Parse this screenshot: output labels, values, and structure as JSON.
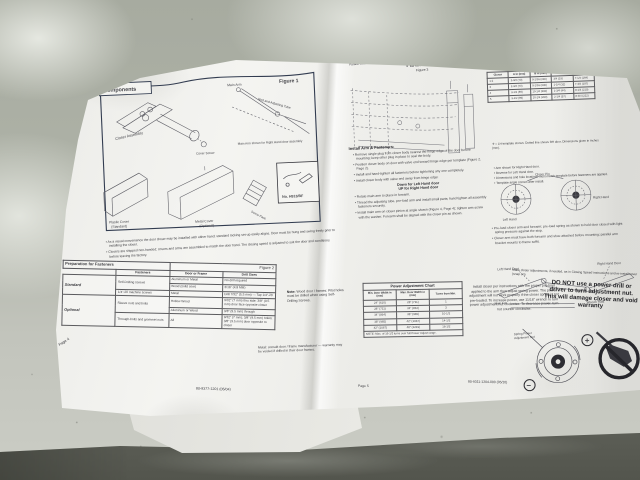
{
  "colors": {
    "surface": "#a7aba0",
    "paper": "#f0f0ed",
    "ink": "#3c3c40",
    "figure_border": "#323c50",
    "bag_dark": "#53554d"
  },
  "left_page": {
    "header_label": "Components",
    "figure_label": "Figure 1",
    "diagram": {
      "closer_assembly": "Closer Assembly",
      "main_arm": "Main Arm",
      "rod_tube": "Rod and Adjusting Tube",
      "arm_note": "Main Arm shown for Right Hand door assembly",
      "cover_screw": "Cover Screw",
      "plastic_cover_1": "Plastic Cover",
      "plastic_cover_2": "(Standard)",
      "metal_cover_1": "Metal Cover",
      "metal_cover_2": "(Optional)",
      "screw_pack": "Screw Pack",
      "parts_box_no": "No. H913/BF"
    },
    "notes": [
      "As a visual convenience the door closer may be installed with either hand; standard locking set-up easily aligns. Door must be hung and swing freely prior to installing the closer.",
      "Closers are shipped non-handed; covers and arms are assembled to match the door hand. The closing speed is adjusted to suit the door and conditions before leaving the factory."
    ],
    "fastener_table": {
      "title": "Preparation for Fasteners",
      "figure": "Figure 2",
      "col_headers": [
        "Fasteners",
        "Door or Frame",
        "Drill Sizes"
      ],
      "group_standard": "Standard",
      "group_optional": "Optional",
      "rows": {
        "r1": {
          "f": "Self-Drilling screws",
          "d": "Aluminum or Metal",
          "s": "No drill required"
        },
        "r2": {
          "d": "Wood (solid core)",
          "s": "3/16\" (4.8 MM)"
        },
        "r3": {
          "f": "1/4\"-20 machine screws",
          "d": "Metal",
          "s": "Drill 7/32\" (5.5 mm) — Tap 1/4\"-20"
        },
        "r4": {
          "f": "Sleeve nuts and bolts",
          "d": "Hollow Wood",
          "s": "9/32\" (7 mm) thru side; 3/8\" (9.5 mm) door face opposite closer"
        },
        "r5": {
          "d": "Aluminum or Wood",
          "s": "3/8\" (9.5 mm) through"
        },
        "r6": {
          "f": "Through-bolts and grommet nuts",
          "d": "All",
          "s": "9/32\" (7 mm); 3/8\" (9.5 mm) holes; 3/8\" (9.5 mm) door opposite to closer"
        }
      }
    },
    "note_right_title": "Note:",
    "note_right": "Wood door / frames: Pilot holes must be drilled when using Self-Drilling Screws.",
    "metal_note": "Metal: consult door / frame manufacturer — warranty may be voided if drilled in their door frames.",
    "footer_doc": "80-9377-1201 (05/04)",
    "footer_page": "Page 4"
  },
  "right_page": {
    "corner_line1": "Installation",
    "corner_line2": "Parallel Arm",
    "title": "Parallel Arm",
    "subtitle": "Figure 3",
    "dim_table": {
      "headers": [
        "Closer",
        "A in (mm)",
        "B in (mm)",
        "C in (mm)",
        "D in (mm)"
      ],
      "rows": [
        [
          "1-2",
          "2-3/4 (70)",
          "9-1/16 (230)",
          "3/4 (19)",
          "7-1/4 (184)"
        ],
        [
          "3",
          "2-3/4 (70)",
          "9-1/16 (230)",
          "1-1/4 (32)",
          "7-3/4 (197)"
        ],
        [
          "4",
          "3-1/2 (89)",
          "10-1/4 (260)",
          "1-3/4 (44)",
          "8-1/4 (210)"
        ],
        [
          "5",
          "3-1/2 (89)",
          "10-1/4 (260)",
          "2-1/4 (57)",
          "8-3/4 (222)"
        ]
      ]
    },
    "template_note": "✛ = LH template shown. Dotted line shows RH door. Dimensions given in inches (mm).",
    "side_note_lines": [
      "Arm shown for Right Hand door.",
      "Reverse for Left Hand door.",
      "Dimensions and hole locations must match template before fasteners are applied.",
      "Template angle correct after install."
    ],
    "install_heading": "Install Arm & Fasteners:",
    "bullets_a": [
      "Remove single plug from closer body nearest the hinge edge of the door before mounting; keep other plug in place to seal the body.",
      "Position closer body on door with valve end toward hinge edge per template (Figure 2, Page 2).",
      "Install and hand-tighten all fasteners before tightening any one completely.",
      "Install closer body with valve end away from hinge edge:"
    ],
    "bold_line1": "Down for Left Hand door",
    "bold_line2": "UP for Right Hand door",
    "bullets_b": [
      "Rotate main arm to place in forearm.",
      "Thread the adjusting tube, pre-load arm and install small parts; hand tighten all assembly fasteners securely.",
      "Install main arm on closer pinion at angle shown (Figure 4, Page 4); tighten arm screw with the washer. Forearm shall be aligned with the closer pin as shown."
    ],
    "circles": {
      "caption": "Closer Pin",
      "left": "Left Hand",
      "right": "Right Hand"
    },
    "bullets_c": [
      "Pre-load closer arm and forearm; pre-load spring as shown to hold door closed with light spring pressure against the stop.",
      "Closer arm must have both forearm and shoe attached before mounting; parallel arm bracket mounts to frame soffit."
    ],
    "arm_diagram": {
      "left": "Left Hand Door",
      "right": "Right Hand Door",
      "main_arm": "Main Arm",
      "wrench": "Wrench Flats"
    },
    "adjust_line": "Make closer adjustments, if needed, as in Closing Speed instructions and re-install cover (snap on).",
    "power_chart": {
      "title": "Power Adjustment Chart",
      "headers": [
        "Min. Door Width in (mm)",
        "Max. Door Width in (mm)",
        "Turns from Min."
      ],
      "rows": [
        [
          "24\" (610)",
          "28\" (711)",
          "1"
        ],
        [
          "28\" (711)",
          "34\" (864)",
          "3"
        ],
        [
          "34\" (864)",
          "38\" (965)",
          "10-1/2"
        ],
        [
          "38\" (965)",
          "42\" (1067)",
          "14-1/2"
        ],
        [
          "42\" (1067)",
          "48\" (1219)",
          "16-1/2"
        ]
      ],
      "note": "NOTE: Max. of 16-1/2 turns over full Power Adjust range."
    },
    "preload_text": "Install closer per instructions with the proper pre-load applied to the arm then adjust spring power. The power adjustment will not work properly if the closer spring is not pre-loaded. To increase power, use 11/16\" wrench to turn power adjustment nut clockwise. To decrease power, turn nut counter clockwise.",
    "warning": "DO NOT use a power drill or driver to turn adjustment nut. This will damage closer and void warranty",
    "nut_label_1": "Spring Power",
    "nut_label_2": "Adjustment Nut",
    "plus": "+",
    "minus": "−",
    "footer_page": "Page 5",
    "footer_doc": "80-9311-1204-000 (05/10)"
  }
}
